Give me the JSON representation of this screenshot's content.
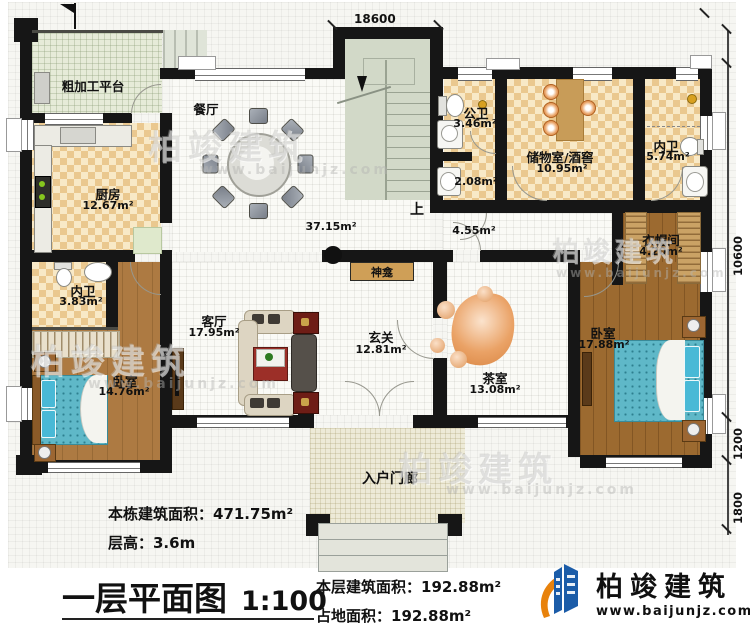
{
  "rooms": {
    "platform": {
      "name": "粗加工平台"
    },
    "kitchen": {
      "name": "厨房",
      "area": "12.67m²"
    },
    "dining": {
      "name": "餐厅",
      "area": "37.15m²"
    },
    "stairs": {
      "up": "上"
    },
    "public_bath": {
      "name": "公卫",
      "area": "3.46m²"
    },
    "bath_small": {
      "area": "2.08m²"
    },
    "storage": {
      "name": "储物室/酒窖",
      "area": "10.95m²"
    },
    "ensuite_top": {
      "name": "内卫",
      "area": "5.74m²"
    },
    "corridor": {
      "area": "4.55m²"
    },
    "cloakroom": {
      "name": "衣帽间",
      "area": "4.20m²"
    },
    "shrine": {
      "name": "神龛"
    },
    "living": {
      "name": "客厅",
      "area": "17.95m²"
    },
    "foyer": {
      "name": "玄关",
      "area": "12.81m²"
    },
    "tea": {
      "name": "茶室",
      "area": "13.08m²"
    },
    "bedroom_right": {
      "name": "卧室",
      "area": "17.88m²"
    },
    "ensuite_left": {
      "name": "内卫",
      "area": "3.83m²"
    },
    "bedroom_left": {
      "name": "卧室",
      "area": "14.76m²"
    },
    "porch": {
      "name": "入户门廊"
    }
  },
  "dimensions": {
    "top": "18600",
    "right_main": "10600",
    "right_mid": "1200",
    "right_bottom": "1800"
  },
  "title_block": {
    "total_area": "本栋建筑面积：471.75m²",
    "floor_height": "层高：3.6m",
    "title": "一层平面图",
    "scale": "1:100",
    "floor_area": "本层建筑面积：192.88m²",
    "footprint_area": "占地面积：192.88m²"
  },
  "brand": {
    "name": "柏竣建筑",
    "website": "www.baijunjz.com",
    "blue": "#1b5ca8",
    "orange": "#e8820c"
  },
  "watermark": {
    "text": "柏竣建筑",
    "website": "www.baijunjz.com"
  }
}
